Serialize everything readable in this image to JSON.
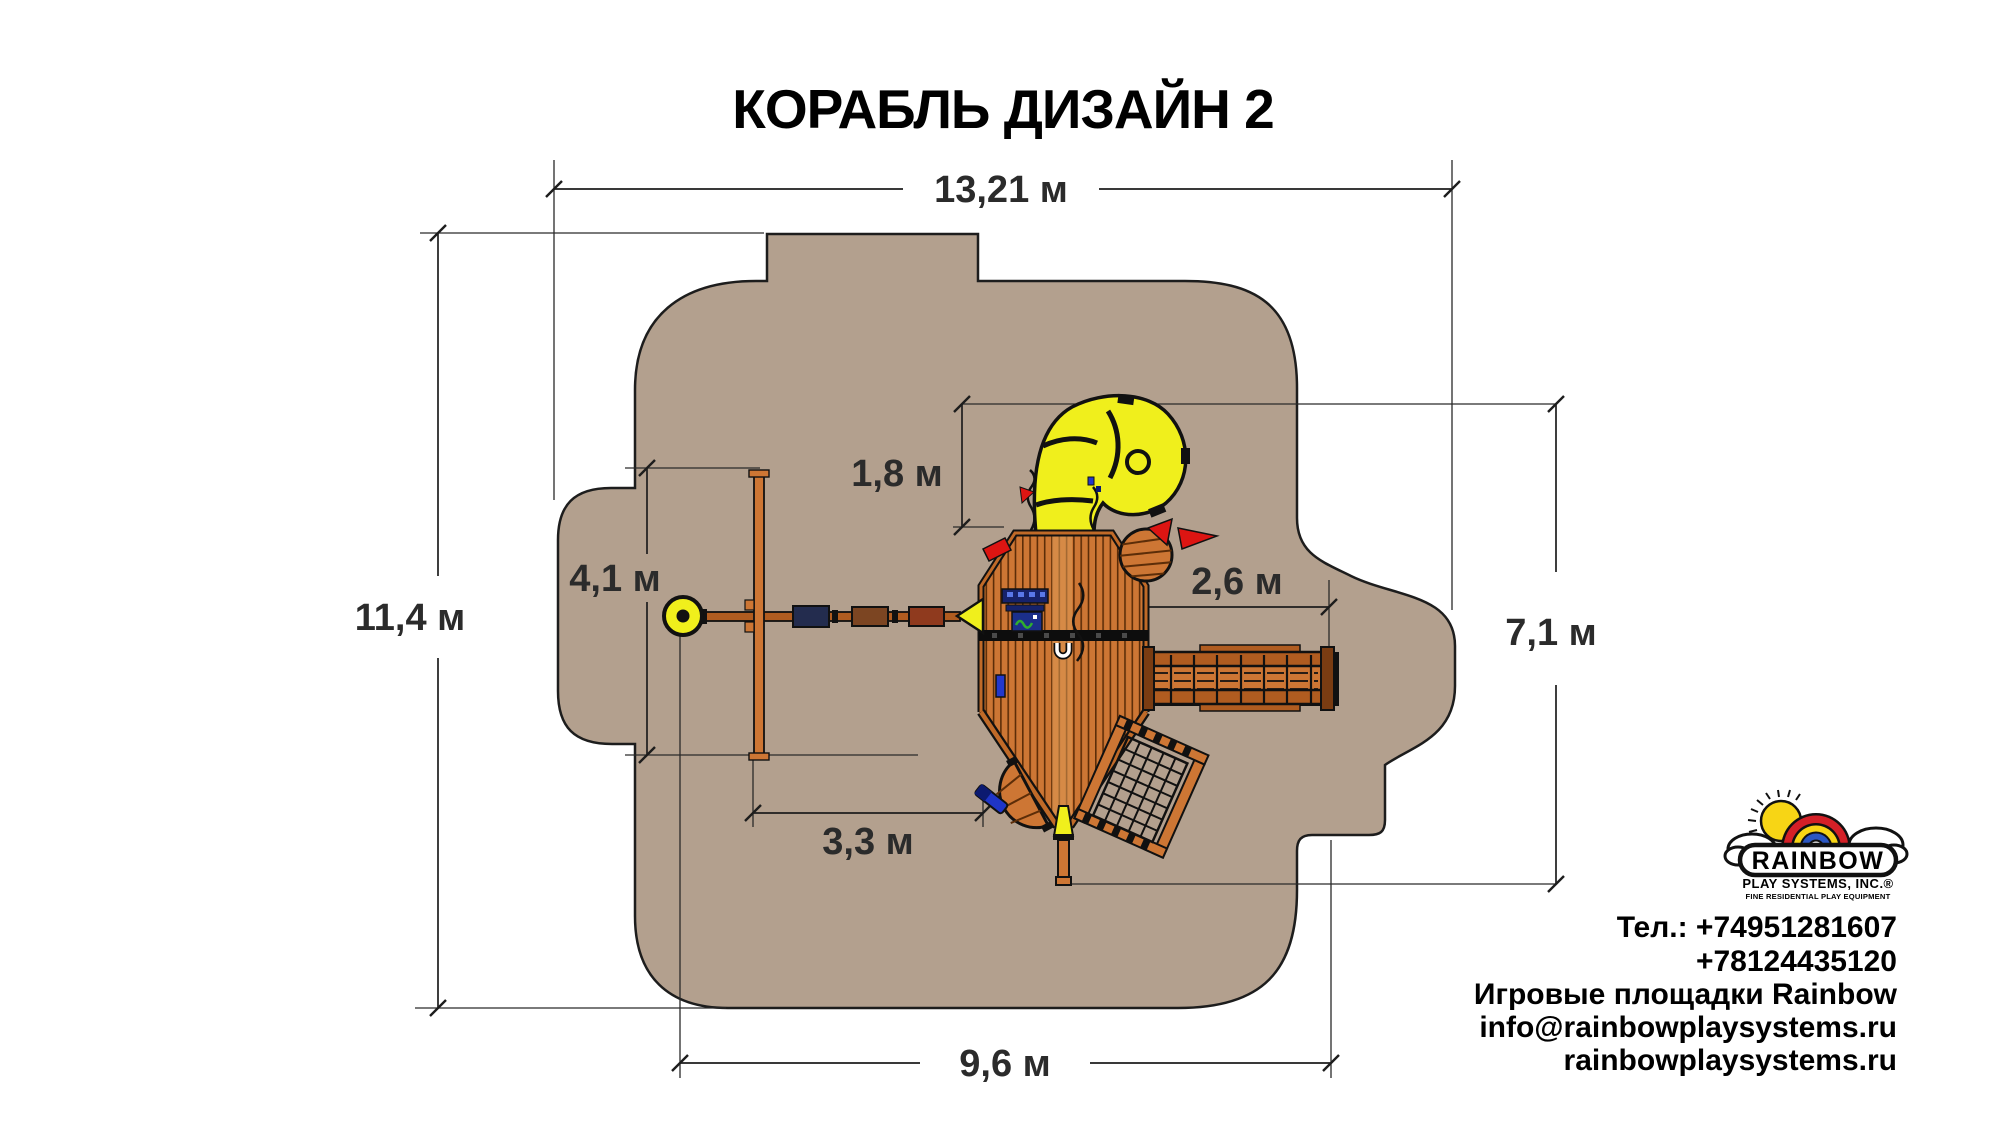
{
  "title": "КОРАБЛЬ ДИЗАЙН 2",
  "dims": {
    "total_width": "13,21 м",
    "total_height": "11,4 м",
    "swing_frame": "4,1 м",
    "slide_zone": "1,8 м",
    "bridge": "2,6 м",
    "right_height": "7,1 м",
    "bow_offset": "3,3 м",
    "bottom_width": "9,6 м"
  },
  "logo": {
    "brand": "RAINBOW",
    "subtitle": "PLAY SYSTEMS, INC.®",
    "tagline": "FINE RESIDENTIAL PLAY EQUIPMENT"
  },
  "contact": {
    "phone1": "Тел.: +74951281607",
    "phone2": "+78124435120",
    "line3": "Игровые площадки Rainbow",
    "email": "info@rainbowplaysystems.ru",
    "site": "rainbowplaysystems.ru"
  },
  "colors": {
    "safety_zone": "#b3a08e",
    "outline": "#1d1d1d",
    "wood": "#cd7634",
    "wood_dark_line": "#5c2d08",
    "wood_rail": "#b05c20",
    "slide_yellow": "#f0ef1c",
    "accent_red": "#dd1512",
    "navy": "#16226b",
    "blue": "#2338cc",
    "dim_text": "#2b2b2b"
  }
}
